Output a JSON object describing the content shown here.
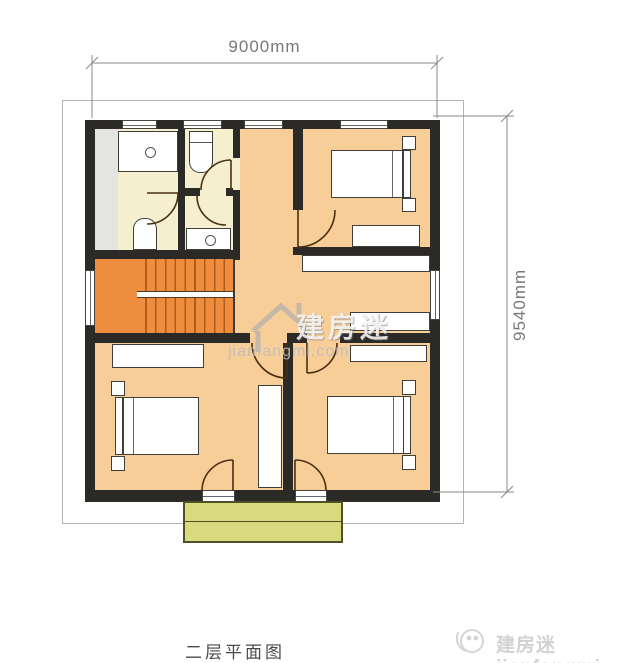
{
  "drawing": {
    "caption": "二层平面图",
    "dimensions": {
      "width_label": "9000mm",
      "height_label": "9540mm"
    }
  },
  "watermarks": {
    "center_brand": "建房迷",
    "center_site": "jianfangmi.com",
    "footer_text": "建房迷jianfangmi"
  },
  "colors": {
    "wall": "#2b2a27",
    "floor_main": "#f7cd98",
    "floor_bathroom": "#f5efcf",
    "floor_gray_strip": "#e4e4e1",
    "stairs": "#ef8d3e",
    "stair_tread_line": "#b05c1a",
    "balcony_fill": "#d9d97e",
    "balcony_border": "#4f4f28",
    "furniture_fill": "#ffffff",
    "door_arc": "#4a3010",
    "dimension_line": "#8a8a8a",
    "caption_text": "#4b4b4b",
    "watermark_gray": "#d2d2d2"
  }
}
